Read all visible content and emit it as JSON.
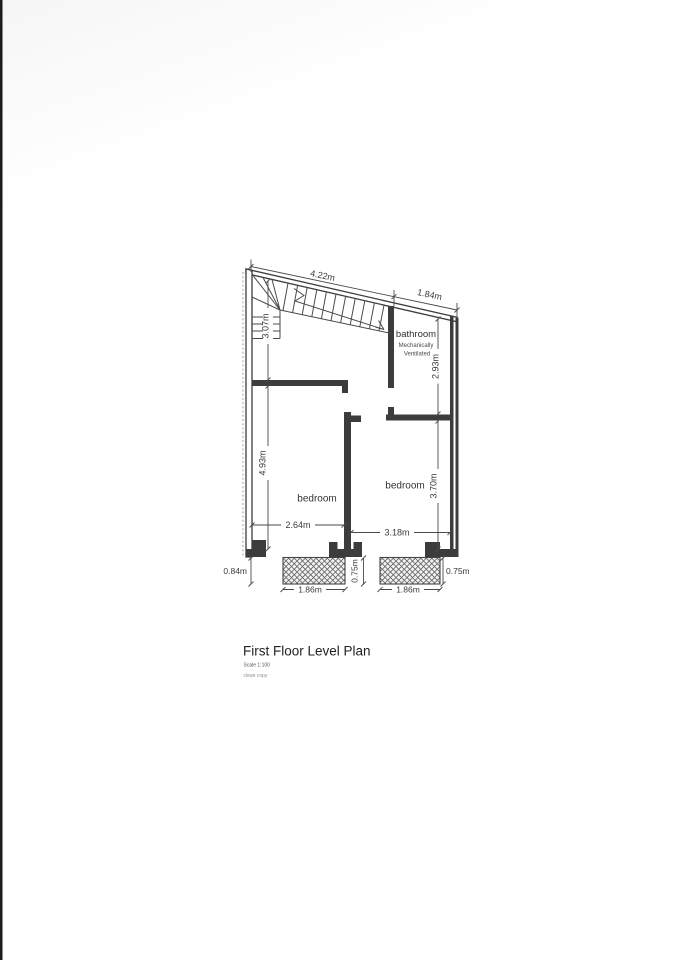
{
  "document": {
    "title": "First Floor Level Plan",
    "scale_note": "Scale 1:100",
    "copy_note": "clean copy"
  },
  "rooms": {
    "bathroom": {
      "label": "bathroom",
      "note_line1": "Mechanically",
      "note_line2": "Ventilated"
    },
    "bedroom_left": {
      "label": "bedroom"
    },
    "bedroom_right": {
      "label": "bedroom"
    }
  },
  "dimensions": {
    "top_left_width": "4.22m",
    "top_right_width": "1.84m",
    "stair_depth": "3.07m",
    "bathroom_depth": "2.93m",
    "bedroom_left_depth": "4.93m",
    "bedroom_left_width": "2.64m",
    "bedroom_right_depth": "3.70m",
    "bedroom_right_width": "3.18m",
    "balcony_left_projection": "0.84m",
    "balcony_mid_projection": "0.75m",
    "balcony_right_projection": "0.75m",
    "balcony_left_width": "1.86m",
    "balcony_right_width": "1.86m"
  },
  "colors": {
    "paper": "#fdfdfd",
    "line": "#3c3c3c",
    "text": "#333333"
  }
}
